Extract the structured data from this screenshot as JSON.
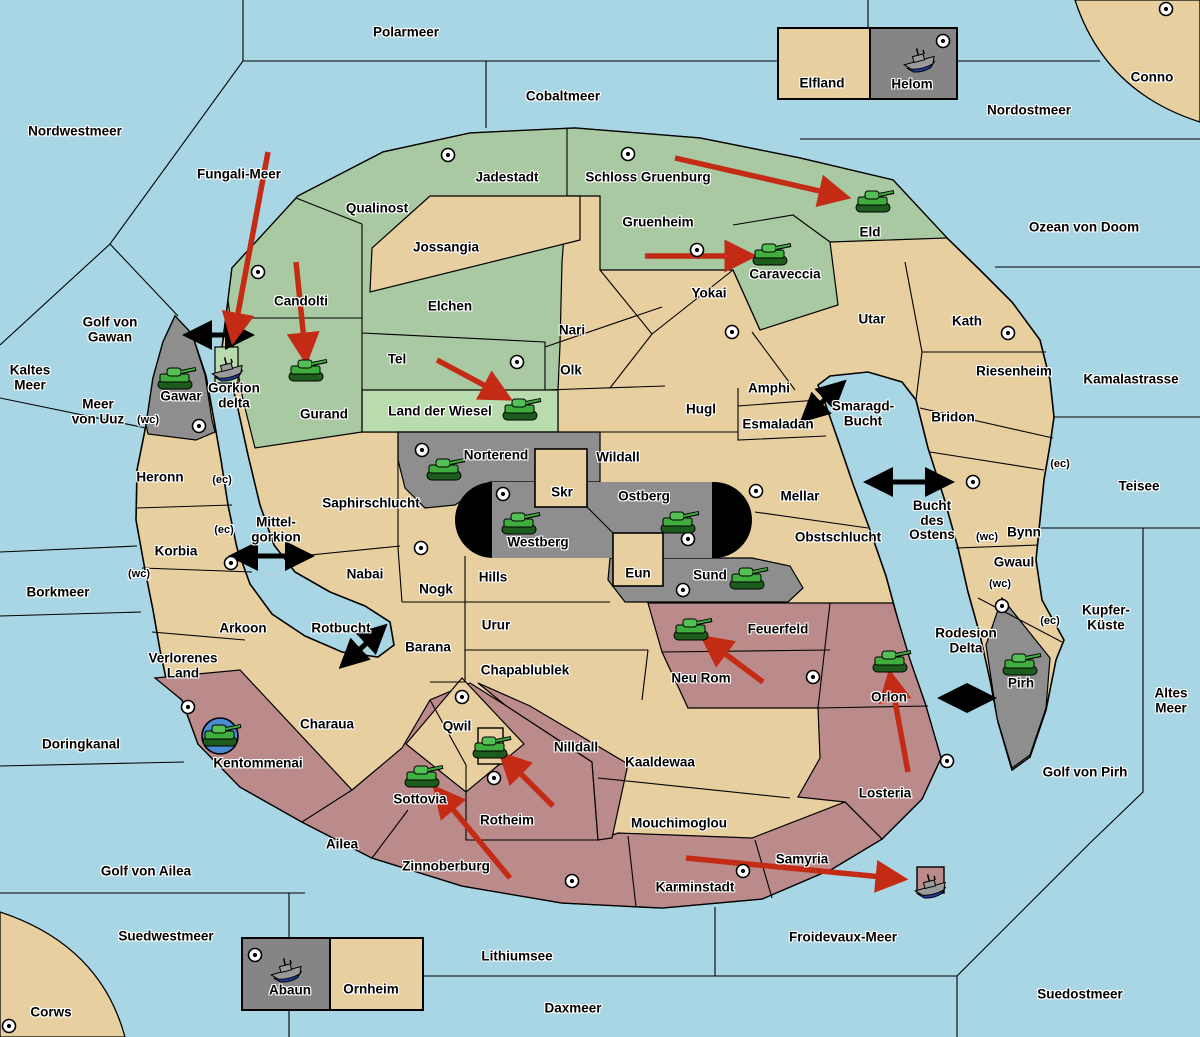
{
  "colors": {
    "sea": "#A9D6E5",
    "land": "#E8CFA0",
    "green": "#A8C9A1",
    "lightgreen": "#B9DCAE",
    "gray": "#8E8E8E",
    "boxgray": "#858585",
    "red": "#BB8A8A",
    "border": "#000000",
    "attack_arrow": "#C42B15",
    "link_arrow": "#000000",
    "tank_body": "#3FAE3F",
    "tank_turret": "#55C055",
    "tank_tread": "#1D5C1D",
    "ship_hull": "#9A9A9A",
    "ship_keel": "#1F3E9E",
    "transport_circle": "#4A8CD4",
    "city_fill": "#FFFFFF"
  },
  "seas": [
    {
      "name": "Polarmeer",
      "x": 406,
      "y": 33
    },
    {
      "name": "Cobaltmeer",
      "x": 563,
      "y": 97
    },
    {
      "name": "Nordostmeer",
      "x": 1029,
      "y": 111
    },
    {
      "name": "Nordwestmeer",
      "x": 75,
      "y": 132
    },
    {
      "name": "Fungali-Meer",
      "x": 239,
      "y": 175
    },
    {
      "name": "Ozean von Doom",
      "x": 1084,
      "y": 228
    },
    {
      "name": "Golf von\nGawan",
      "x": 110,
      "y": 330
    },
    {
      "name": "Kaltes\nMeer",
      "x": 30,
      "y": 378
    },
    {
      "name": "Meer\nvon Uuz",
      "x": 98,
      "y": 412
    },
    {
      "name": "Kamalastrasse",
      "x": 1131,
      "y": 380
    },
    {
      "name": "Teisee",
      "x": 1139,
      "y": 487
    },
    {
      "name": "Kupfer-\nKüste",
      "x": 1106,
      "y": 618
    },
    {
      "name": "Altes\nMeer",
      "x": 1171,
      "y": 701
    },
    {
      "name": "Borkmeer",
      "x": 58,
      "y": 593
    },
    {
      "name": "Doringkanal",
      "x": 81,
      "y": 745
    },
    {
      "name": "Golf von Ailea",
      "x": 146,
      "y": 872
    },
    {
      "name": "Suedwestmeer",
      "x": 166,
      "y": 937
    },
    {
      "name": "Lithiumsee",
      "x": 517,
      "y": 957
    },
    {
      "name": "Daxmeer",
      "x": 573,
      "y": 1009
    },
    {
      "name": "Froidevaux-Meer",
      "x": 843,
      "y": 938
    },
    {
      "name": "Suedostmeer",
      "x": 1080,
      "y": 995
    },
    {
      "name": "Golf von Pirh",
      "x": 1085,
      "y": 773
    },
    {
      "name": "Smaragd-\nBucht",
      "x": 863,
      "y": 414
    },
    {
      "name": "Bucht\ndes\nOstens",
      "x": 932,
      "y": 521
    },
    {
      "name": "Rodesion\nDelta",
      "x": 966,
      "y": 641
    },
    {
      "name": "Mittel-\ngorkion",
      "x": 276,
      "y": 530
    },
    {
      "name": "Rotbucht",
      "x": 341,
      "y": 629
    }
  ],
  "territories": [
    {
      "name": "Candolti",
      "x": 301,
      "y": 302,
      "color": "green",
      "city": [
        258,
        272
      ]
    },
    {
      "name": "Qualinost",
      "x": 377,
      "y": 209,
      "color": "green"
    },
    {
      "name": "Jadestadt",
      "x": 507,
      "y": 178,
      "color": "green",
      "city": [
        448,
        155
      ]
    },
    {
      "name": "Schloss Gruenburg",
      "x": 648,
      "y": 178,
      "color": "green",
      "city": [
        628,
        154
      ]
    },
    {
      "name": "Gruenheim",
      "x": 658,
      "y": 223,
      "color": "green",
      "city": [
        697,
        250
      ]
    },
    {
      "name": "Eld",
      "x": 870,
      "y": 233,
      "color": "green"
    },
    {
      "name": "Caraveccia",
      "x": 785,
      "y": 275,
      "color": "green"
    },
    {
      "name": "Elchen",
      "x": 450,
      "y": 307,
      "color": "green"
    },
    {
      "name": "Tel",
      "x": 397,
      "y": 360,
      "color": "green",
      "city": [
        517,
        362
      ]
    },
    {
      "name": "Gurand",
      "x": 324,
      "y": 415,
      "color": "green"
    },
    {
      "name": "Land der Wiesel",
      "x": 440,
      "y": 412,
      "color": "lightgreen"
    },
    {
      "name": "Gorkion\ndelta",
      "x": 234,
      "y": 396,
      "color": "lightgreen"
    },
    {
      "name": "Gawar",
      "x": 181,
      "y": 397,
      "color": "gray",
      "city": [
        199,
        426
      ]
    },
    {
      "name": "Norterend",
      "x": 496,
      "y": 456,
      "color": "gray",
      "city": [
        422,
        450
      ]
    },
    {
      "name": "Westberg",
      "x": 538,
      "y": 543,
      "color": "gray",
      "city": [
        503,
        494
      ]
    },
    {
      "name": "Ostberg",
      "x": 644,
      "y": 497,
      "color": "gray",
      "city": [
        688,
        539
      ]
    },
    {
      "name": "Sund",
      "x": 710,
      "y": 576,
      "color": "gray",
      "city": [
        683,
        590
      ]
    },
    {
      "name": "Pirh",
      "x": 1021,
      "y": 684,
      "color": "gray",
      "city": [
        1002,
        606
      ]
    },
    {
      "name": "Helom",
      "x": 912,
      "y": 85,
      "color": "gray",
      "city": [
        943,
        41
      ]
    },
    {
      "name": "Abaun",
      "x": 290,
      "y": 991,
      "color": "gray",
      "city": [
        255,
        955
      ]
    },
    {
      "name": "Kentommenai",
      "x": 258,
      "y": 764,
      "color": "red",
      "city": [
        188,
        707
      ]
    },
    {
      "name": "Ailea",
      "x": 342,
      "y": 845,
      "color": "red"
    },
    {
      "name": "Zinnoberburg",
      "x": 446,
      "y": 867,
      "color": "red",
      "city": [
        572,
        881
      ]
    },
    {
      "name": "Sottovia",
      "x": 420,
      "y": 800,
      "color": "red"
    },
    {
      "name": "Rotheim",
      "x": 507,
      "y": 821,
      "color": "red",
      "city": [
        494,
        778
      ]
    },
    {
      "name": "Nilldall",
      "x": 576,
      "y": 748,
      "color": "red"
    },
    {
      "name": "Karminstadt",
      "x": 695,
      "y": 888,
      "color": "red",
      "city": [
        743,
        871
      ]
    },
    {
      "name": "Samyria",
      "x": 802,
      "y": 860,
      "color": "red"
    },
    {
      "name": "Losteria",
      "x": 885,
      "y": 794,
      "color": "red",
      "city": [
        947,
        761
      ]
    },
    {
      "name": "Orlon",
      "x": 889,
      "y": 698,
      "color": "red"
    },
    {
      "name": "Neu Rom",
      "x": 701,
      "y": 679,
      "color": "red",
      "city": [
        813,
        677
      ]
    },
    {
      "name": "Feuerfeld",
      "x": 778,
      "y": 630,
      "color": "red"
    },
    {
      "name": "Jossangia",
      "x": 446,
      "y": 248,
      "color": "tan"
    },
    {
      "name": "Yokai",
      "x": 709,
      "y": 294,
      "color": "tan",
      "city": [
        732,
        332
      ]
    },
    {
      "name": "Nari",
      "x": 572,
      "y": 331,
      "color": "tan"
    },
    {
      "name": "Olk",
      "x": 571,
      "y": 371,
      "color": "tan"
    },
    {
      "name": "Hugl",
      "x": 701,
      "y": 410,
      "color": "tan"
    },
    {
      "name": "Amphi",
      "x": 769,
      "y": 389,
      "color": "tan"
    },
    {
      "name": "Esmaladan",
      "x": 778,
      "y": 425,
      "color": "tan"
    },
    {
      "name": "Utar",
      "x": 872,
      "y": 320,
      "color": "tan"
    },
    {
      "name": "Kath",
      "x": 967,
      "y": 322,
      "color": "tan",
      "city": [
        1008,
        333
      ]
    },
    {
      "name": "Riesenheim",
      "x": 1014,
      "y": 372,
      "color": "tan"
    },
    {
      "name": "Bridon",
      "x": 953,
      "y": 418,
      "color": "tan"
    },
    {
      "name": "Bynn",
      "x": 1024,
      "y": 533,
      "color": "tan",
      "city": [
        973,
        482
      ]
    },
    {
      "name": "Gwaul",
      "x": 1014,
      "y": 563,
      "color": "tan"
    },
    {
      "name": "Wildall",
      "x": 618,
      "y": 458,
      "color": "tan"
    },
    {
      "name": "Skr",
      "x": 562,
      "y": 493,
      "color": "tan"
    },
    {
      "name": "Eun",
      "x": 638,
      "y": 574,
      "color": "tan"
    },
    {
      "name": "Mellar",
      "x": 800,
      "y": 497,
      "color": "tan",
      "city": [
        756,
        491
      ]
    },
    {
      "name": "Obstschlucht",
      "x": 838,
      "y": 538,
      "color": "tan"
    },
    {
      "name": "Saphirschlucht",
      "x": 371,
      "y": 504,
      "color": "tan"
    },
    {
      "name": "Nabai",
      "x": 365,
      "y": 575,
      "color": "tan"
    },
    {
      "name": "Hills",
      "x": 493,
      "y": 578,
      "color": "tan",
      "city": [
        421,
        548
      ]
    },
    {
      "name": "Nogk",
      "x": 436,
      "y": 590,
      "color": "tan"
    },
    {
      "name": "Urur",
      "x": 496,
      "y": 626,
      "color": "tan"
    },
    {
      "name": "Barana",
      "x": 428,
      "y": 648,
      "color": "tan"
    },
    {
      "name": "Chapablublek",
      "x": 525,
      "y": 671,
      "color": "tan"
    },
    {
      "name": "Qwil",
      "x": 457,
      "y": 727,
      "color": "tan",
      "city": [
        462,
        697
      ]
    },
    {
      "name": "Kaaldewaa",
      "x": 660,
      "y": 763,
      "color": "tan"
    },
    {
      "name": "Mouchimoglou",
      "x": 679,
      "y": 824,
      "color": "tan"
    },
    {
      "name": "Heronn",
      "x": 160,
      "y": 478,
      "color": "tan"
    },
    {
      "name": "Korbia",
      "x": 176,
      "y": 552,
      "color": "tan",
      "city": [
        231,
        563
      ]
    },
    {
      "name": "Arkoon",
      "x": 243,
      "y": 629,
      "color": "tan"
    },
    {
      "name": "Verlorenes\nLand",
      "x": 183,
      "y": 666,
      "color": "tan"
    },
    {
      "name": "Charaua",
      "x": 327,
      "y": 725,
      "color": "tan"
    },
    {
      "name": "Elfland",
      "x": 822,
      "y": 84,
      "color": "tan"
    },
    {
      "name": "Ornheim",
      "x": 371,
      "y": 990,
      "color": "tan"
    },
    {
      "name": "Conno",
      "x": 1152,
      "y": 78,
      "color": "tan",
      "city": [
        1166,
        9
      ]
    },
    {
      "name": "Corws",
      "x": 51,
      "y": 1013,
      "color": "tan",
      "city": [
        9,
        1026
      ]
    }
  ],
  "coast_marks": [
    {
      "text": "(wc)",
      "x": 148,
      "y": 421
    },
    {
      "text": "(ec)",
      "x": 222,
      "y": 481
    },
    {
      "text": "(ec)",
      "x": 224,
      "y": 531
    },
    {
      "text": "(wc)",
      "x": 139,
      "y": 575
    },
    {
      "text": "(ec)",
      "x": 1060,
      "y": 465
    },
    {
      "text": "(wc)",
      "x": 987,
      "y": 538
    },
    {
      "text": "(wc)",
      "x": 1000,
      "y": 585
    },
    {
      "text": "(ec)",
      "x": 1050,
      "y": 622
    }
  ],
  "units": {
    "tanks": [
      [
        175,
        379
      ],
      [
        306,
        371
      ],
      [
        520,
        410
      ],
      [
        873,
        202
      ],
      [
        770,
        255
      ],
      [
        444,
        470
      ],
      [
        519,
        524
      ],
      [
        678,
        523
      ],
      [
        747,
        579
      ],
      [
        691,
        630
      ],
      [
        890,
        662
      ],
      [
        1020,
        665
      ],
      [
        490,
        748
      ],
      [
        422,
        777
      ]
    ],
    "tank_in_circle": [
      [
        220,
        736
      ]
    ],
    "ships": [
      [
        920,
        62
      ],
      [
        228,
        371
      ],
      [
        287,
        972
      ],
      [
        931,
        888
      ]
    ]
  },
  "attack_arrows": [
    [
      268,
      152,
      233,
      340
    ],
    [
      296,
      262,
      306,
      360
    ],
    [
      437,
      360,
      508,
      398
    ],
    [
      675,
      158,
      846,
      197
    ],
    [
      645,
      256,
      752,
      256
    ],
    [
      763,
      682,
      704,
      638
    ],
    [
      908,
      772,
      890,
      674
    ],
    [
      510,
      878,
      436,
      789
    ],
    [
      553,
      806,
      502,
      755
    ],
    [
      686,
      858,
      903,
      879
    ]
  ],
  "link_arrows": [
    [
      207,
      335,
      250,
      335
    ],
    [
      818,
      406,
      843,
      383
    ],
    [
      253,
      556,
      310,
      556
    ],
    [
      888,
      482,
      950,
      482
    ],
    [
      357,
      652,
      384,
      627
    ],
    [
      962,
      698,
      992,
      698
    ]
  ]
}
